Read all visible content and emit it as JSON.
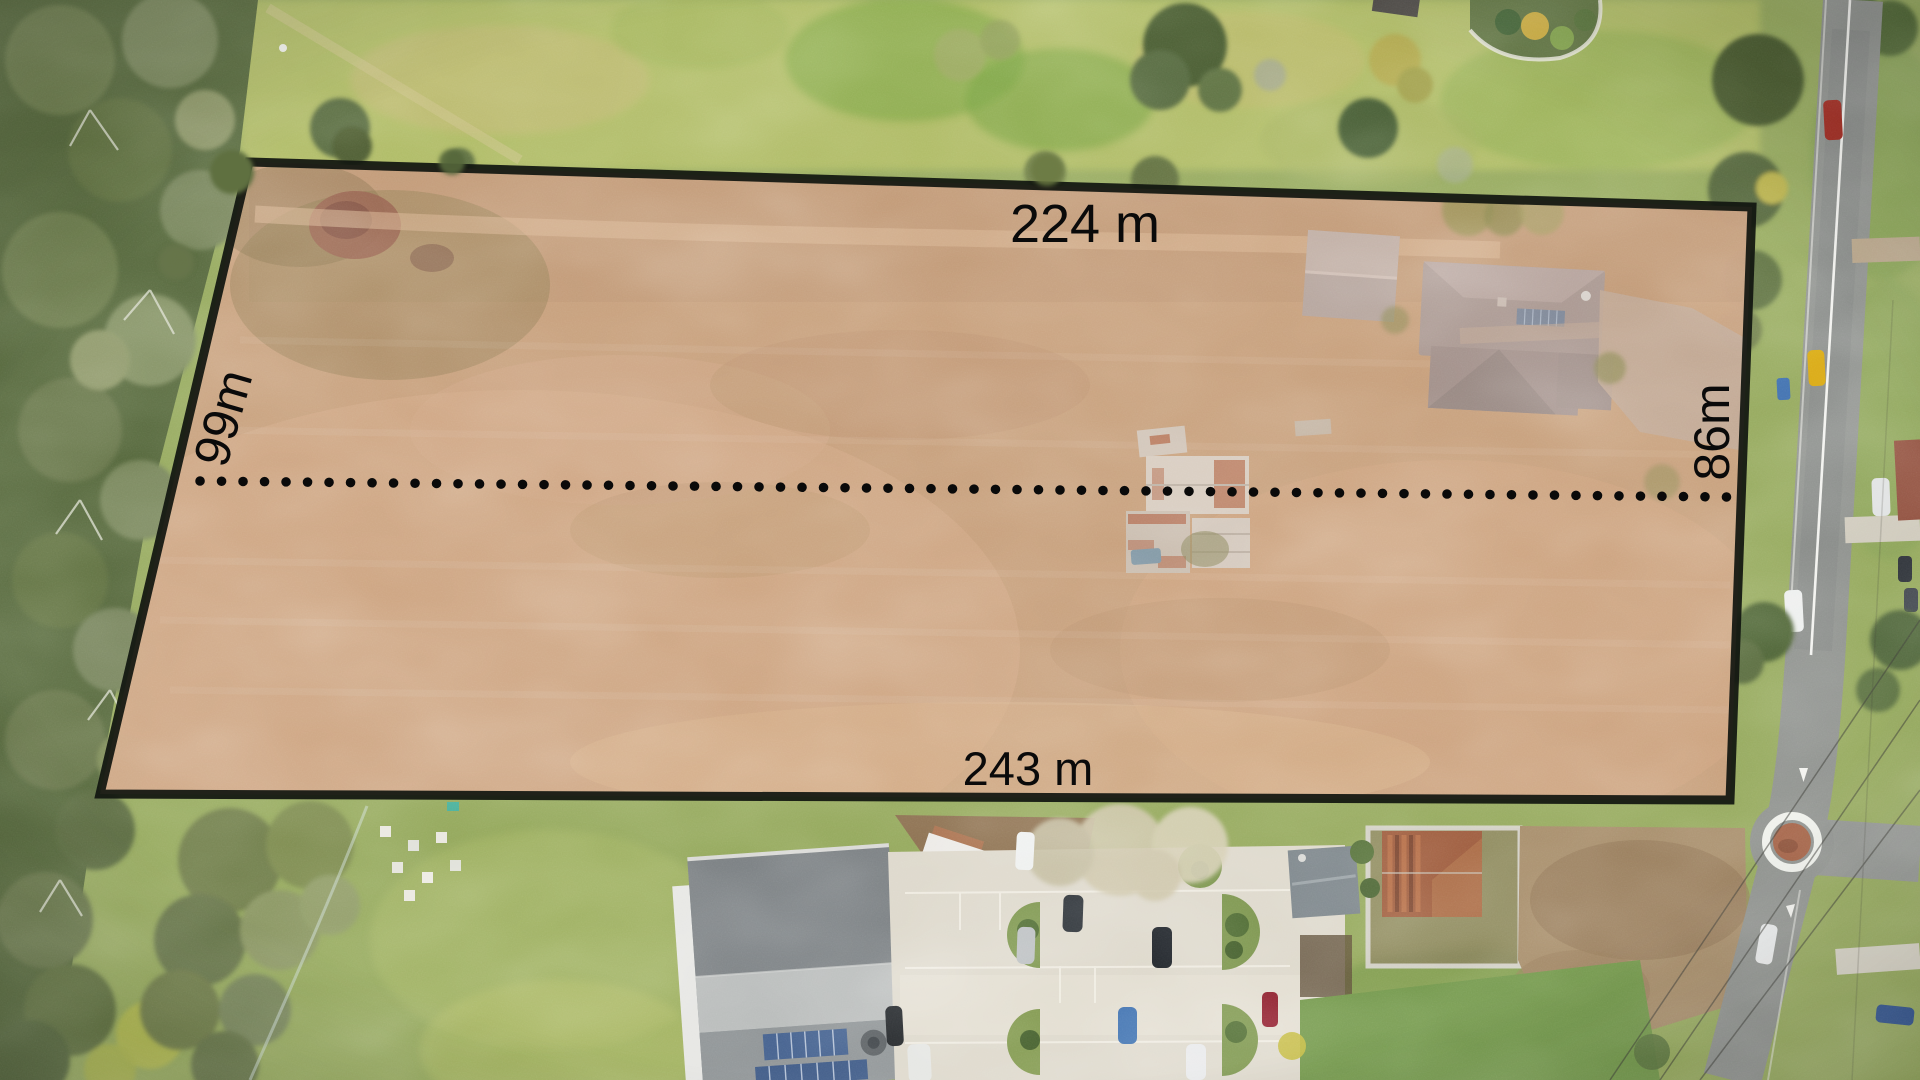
{
  "meta": {
    "description": "Aerial drone photograph of a rural land parcel highlighted for sale, with overlaid boundary and lot dimensions"
  },
  "labels": {
    "top_width": "224 m",
    "bottom_width": "243 m",
    "left_depth": "99m",
    "right_depth": "86m"
  },
  "colors": {
    "parcel_fill": "#c89d7c",
    "parcel_border": "#10150f",
    "label_text": "#0a0a0a",
    "dotted_line": "#0a0a0a",
    "grass_base": "#94a85c",
    "road_asphalt": "#8d908c"
  }
}
